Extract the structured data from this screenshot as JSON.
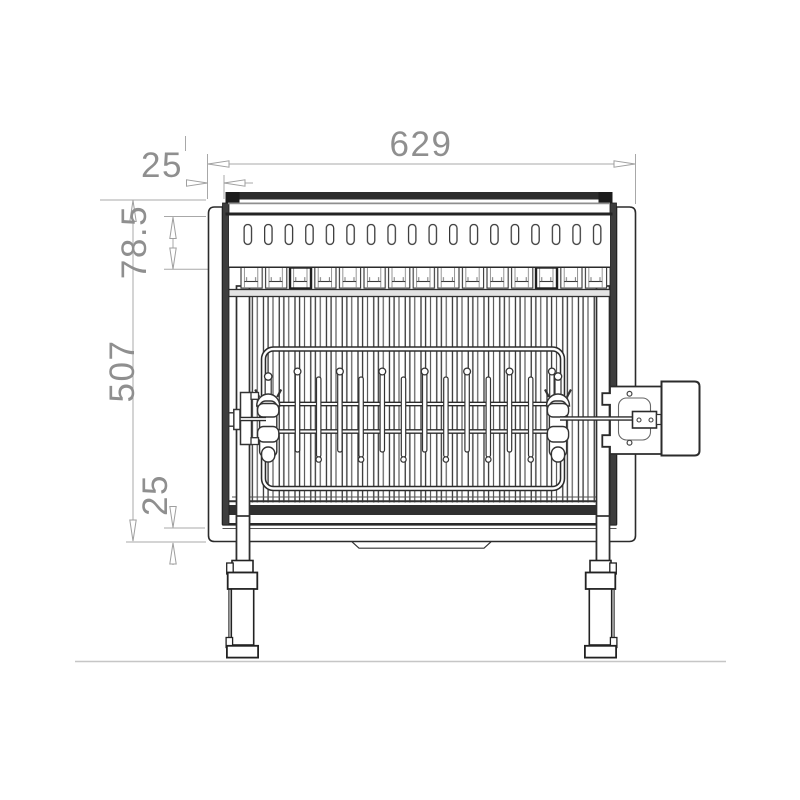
{
  "drawing": {
    "type": "technical-front-view",
    "subject": "rotisserie-grill",
    "dimensions": {
      "total_width": "629",
      "panel_inset": "25",
      "vent_band_height": "78.5",
      "body_height": "507",
      "base_skirt_height": "25"
    },
    "colors": {
      "dimension_gray": "#9a9a9a",
      "line_dark": "#2b2b2b",
      "ground_gray": "#c6c6c6",
      "background": "#ffffff"
    }
  }
}
